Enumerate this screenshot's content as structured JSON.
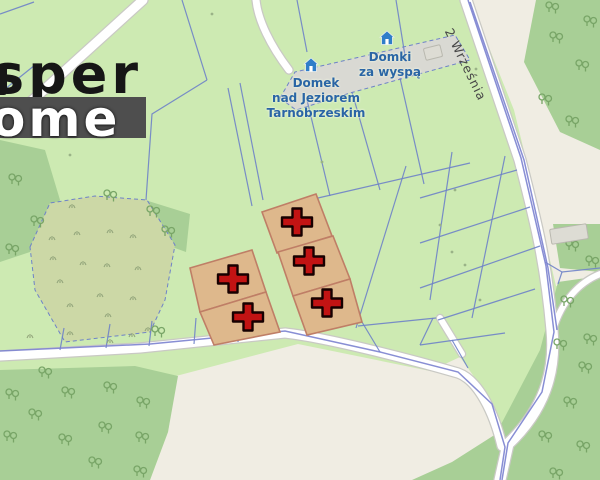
{
  "watermark": {
    "top_text": "sper",
    "bottom_text": "ome"
  },
  "street_label": {
    "text": "2 Września"
  },
  "pois": [
    {
      "name": "lodging-1",
      "icon": "house-icon",
      "lines": [
        "Domek",
        "nad Jeziorem",
        "Tarnobrzeskim"
      ]
    },
    {
      "name": "lodging-2",
      "icon": "house-icon",
      "lines": [
        "Domki",
        "za wyspą"
      ]
    }
  ],
  "colors": {
    "base_green": "#cdeab2",
    "scrub": "#ccd8a6",
    "forest": "#a8cf96",
    "tree_stroke": "#78a567",
    "tuft_stroke": "#93a57b",
    "beige": "#f0ede3",
    "gray_band": "#d9d9d3",
    "road_fill": "#ffffff",
    "road_casing": "#c9c9c4",
    "parcel_line": "#6e82c8",
    "road_boundary_line": "#7b82cf",
    "highlight_fill": "#deb88c",
    "highlight_stroke": "#bf7e66",
    "cross_fill": "#c21313",
    "cross_stroke": "#170000",
    "poi_blue": "#2f7ec9",
    "label_blue": "#2a65a5",
    "street_text": "#474747"
  },
  "map": {
    "areas": [
      {
        "name": "beige-open-topright",
        "fill": "#f0ede3",
        "points": "470,0 600,0 600,290 556,286 536,200 514,110"
      },
      {
        "name": "forest-topright",
        "fill": "#a8cf96",
        "points": "536,0 600,0 600,150 560,132 524,62"
      },
      {
        "name": "forest-patch-right",
        "fill": "#a8cf96",
        "points": "553,224 600,224 600,272 560,268"
      },
      {
        "name": "beige-open-bottom",
        "fill": "#f0ede3",
        "points": "176,376 298,344 430,371 460,357 492,402 504,446 500,480 150,480 168,432"
      },
      {
        "name": "forest-bottomleft",
        "fill": "#a8cf96",
        "points": "0,370 135,366 178,376 168,432 150,480 0,480"
      },
      {
        "name": "forest-bottomright",
        "fill": "#a8cf96",
        "points": "558,282 600,276 600,480 412,480 452,462 496,434 540,350"
      },
      {
        "name": "forest-left-strip",
        "fill": "#a8cf96",
        "points": "0,140 45,150 60,200 30,252 0,262"
      },
      {
        "name": "forest-wedge-midleft",
        "fill": "#a8cf96",
        "points": "145,200 190,214 186,252 158,242"
      },
      {
        "name": "scrub-area",
        "fill": "#ccd8a6",
        "stroke": "#6e82c8",
        "dash": "4,3",
        "points": "30,247 50,203 95,196 147,200 175,245 165,300 150,332 65,342 35,290"
      },
      {
        "name": "grayband-residential",
        "fill": "#d9d9d3",
        "stroke": "#6e82c8",
        "dash": "4,3",
        "points": "280,98 295,72 455,35 470,60 350,93 296,110"
      }
    ],
    "roads": [
      {
        "name": "road-topleft",
        "d": "M143,0 L35,98 L0,128",
        "w": 9
      },
      {
        "name": "road-track-top",
        "d": "M256,0 C258,20 270,45 289,70",
        "w": 7
      },
      {
        "name": "road-2-wrzesnia",
        "d": "M466,0 L520,160 C536,222 546,262 552,330 C556,372 544,410 508,444 L500,480",
        "w": 11
      },
      {
        "name": "road-bottom",
        "d": "M0,356 L140,348 L285,333 C330,338 420,362 458,373 C478,380 494,412 502,446",
        "w": 9
      },
      {
        "name": "road-branch",
        "d": "M440,318 L462,354",
        "w": 6
      },
      {
        "name": "road-track-right",
        "d": "M600,274 C580,282 562,300 553,330",
        "w": 6
      }
    ],
    "parcel_lines": [
      "0,14 34,2",
      "0,93 35,65",
      "182,0 207,80",
      "207,80 152,114 146,200",
      "228,88 252,206",
      "240,83 263,200",
      "297,0 307,52",
      "396,0 406,62",
      "307,100 330,196",
      "352,92 380,190",
      "400,78 424,184",
      "318,198 470,163",
      "420,198 517,170",
      "420,243 530,207",
      "420,288 540,246",
      "438,320 535,289",
      "452,152 430,300",
      "505,156 472,318",
      "406,166 356,328",
      "358,326 436,318",
      "362,322 380,352",
      "420,345 505,333",
      "452,340 468,368",
      "433,318 420,345",
      "545,262 562,272 600,268",
      "562,272 558,284",
      "64,328 60,350",
      "110,324 106,348",
      "152,321 149,346",
      "196,318 194,344",
      "240,320 238,342"
    ],
    "road_boundary_lines": [
      "470,2 524,160 548,268 557,330",
      "0,351 150,344 285,331 380,352 458,372 492,404 505,447 500,480",
      "468,0 521,158 546,266 554,332 542,392 508,443 502,480"
    ],
    "highlight_parcels": [
      {
        "name": "offer-parcel-1",
        "points": "262,212 316,194 332,236 277,253"
      },
      {
        "name": "offer-parcel-2",
        "points": "278,252 333,236 350,279 293,296"
      },
      {
        "name": "offer-parcel-3",
        "points": "293,296 350,279 362,322 307,335"
      },
      {
        "name": "offer-parcel-4",
        "points": "190,268 252,250 266,292 200,312"
      },
      {
        "name": "offer-parcel-5",
        "points": "200,312 266,292 280,332 214,345"
      }
    ],
    "cross_markers": [
      [
        297,
        222
      ],
      [
        309,
        261
      ],
      [
        327,
        303
      ],
      [
        233,
        279
      ],
      [
        248,
        317
      ]
    ],
    "trees": [
      [
        552,
        8
      ],
      [
        590,
        22
      ],
      [
        556,
        38
      ],
      [
        582,
        66
      ],
      [
        545,
        100
      ],
      [
        572,
        122
      ],
      [
        572,
        246
      ],
      [
        592,
        262
      ],
      [
        567,
        302
      ],
      [
        590,
        340
      ],
      [
        560,
        345
      ],
      [
        585,
        368
      ],
      [
        570,
        403
      ],
      [
        545,
        437
      ],
      [
        583,
        447
      ],
      [
        556,
        474
      ],
      [
        12,
        395
      ],
      [
        35,
        415
      ],
      [
        68,
        393
      ],
      [
        110,
        388
      ],
      [
        143,
        403
      ],
      [
        10,
        437
      ],
      [
        65,
        440
      ],
      [
        105,
        428
      ],
      [
        142,
        438
      ],
      [
        95,
        463
      ],
      [
        45,
        373
      ],
      [
        140,
        472
      ],
      [
        15,
        180
      ],
      [
        37,
        222
      ],
      [
        12,
        250
      ],
      [
        153,
        212
      ],
      [
        168,
        232
      ],
      [
        158,
        332
      ],
      [
        110,
        196
      ]
    ],
    "tufts": [
      [
        72,
        208
      ],
      [
        52,
        240
      ],
      [
        77,
        235
      ],
      [
        110,
        233
      ],
      [
        133,
        238
      ],
      [
        53,
        260
      ],
      [
        83,
        265
      ],
      [
        107,
        267
      ],
      [
        138,
        270
      ],
      [
        60,
        283
      ],
      [
        100,
        297
      ],
      [
        133,
        300
      ],
      [
        70,
        307
      ],
      [
        108,
        317
      ],
      [
        30,
        338
      ],
      [
        70,
        335
      ],
      [
        110,
        343
      ],
      [
        132,
        337
      ],
      [
        148,
        331
      ]
    ],
    "dots": [
      [
        70,
        155
      ],
      [
        212,
        14
      ],
      [
        476,
        69
      ],
      [
        322,
        162
      ],
      [
        452,
        252
      ],
      [
        455,
        190
      ],
      [
        440,
        225
      ],
      [
        465,
        265
      ],
      [
        480,
        300
      ]
    ],
    "buildings": [
      {
        "x": 424,
        "y": 46,
        "w": 16,
        "h": 11,
        "rot": -14
      },
      {
        "x": 550,
        "y": 226,
        "w": 36,
        "h": 14,
        "rot": -9
      }
    ],
    "poi_icons": [
      {
        "x": 303,
        "y": 57
      },
      {
        "x": 379,
        "y": 30
      }
    ]
  }
}
